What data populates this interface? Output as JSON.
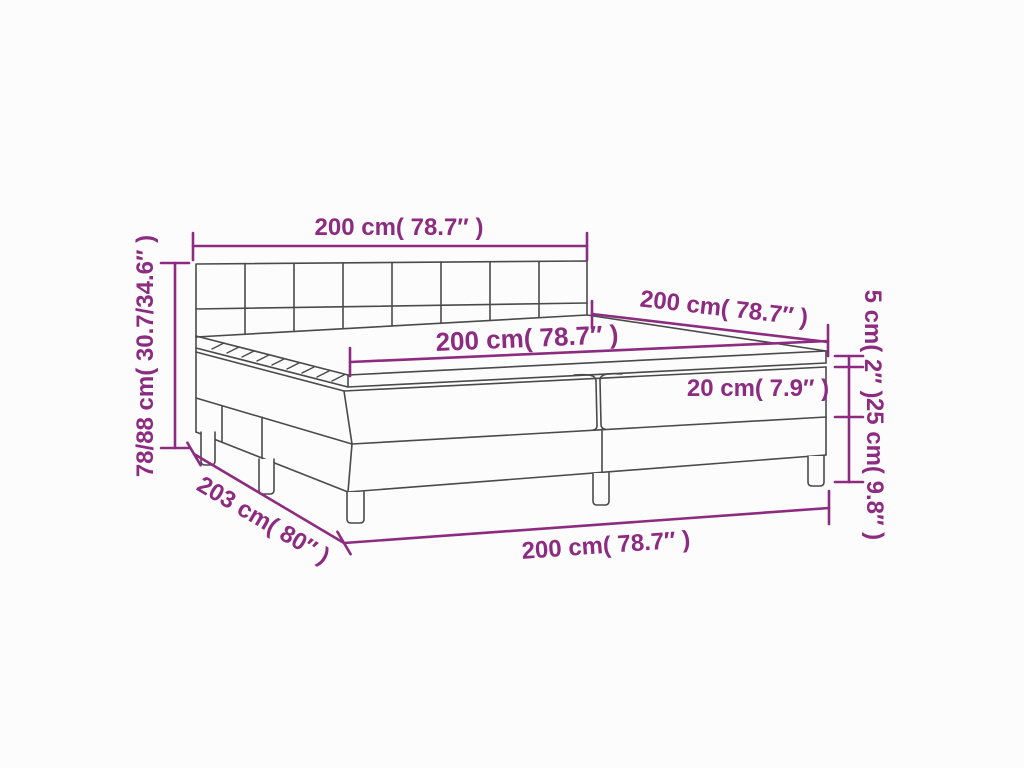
{
  "figure": {
    "type": "product dimension diagram",
    "subject": "box spring bed with headboard, mattress and topper"
  },
  "colors": {
    "dimension_accent": "#8d2b80",
    "line_art": "#4a4a4a",
    "background": "#fcfcfc"
  },
  "dimensions": {
    "headboard_width": {
      "text": "200 cm( 78.7″ )"
    },
    "bed_depth": {
      "text": "200 cm( 78.7″ )"
    },
    "mattress_width": {
      "text": "200 cm( 78.7″ )"
    },
    "total_height": {
      "text": "78/88 cm( 30.7/34.6″ )"
    },
    "topper_height": {
      "text": "5 cm( 2″ )"
    },
    "mattress_height": {
      "text": "20 cm( 7.9″ )"
    },
    "base_height": {
      "text": "25 cm( 9.8″ )"
    },
    "bed_length": {
      "text": "203 cm( 80″ )"
    },
    "base_width": {
      "text": "200 cm( 78.7″ )"
    }
  }
}
